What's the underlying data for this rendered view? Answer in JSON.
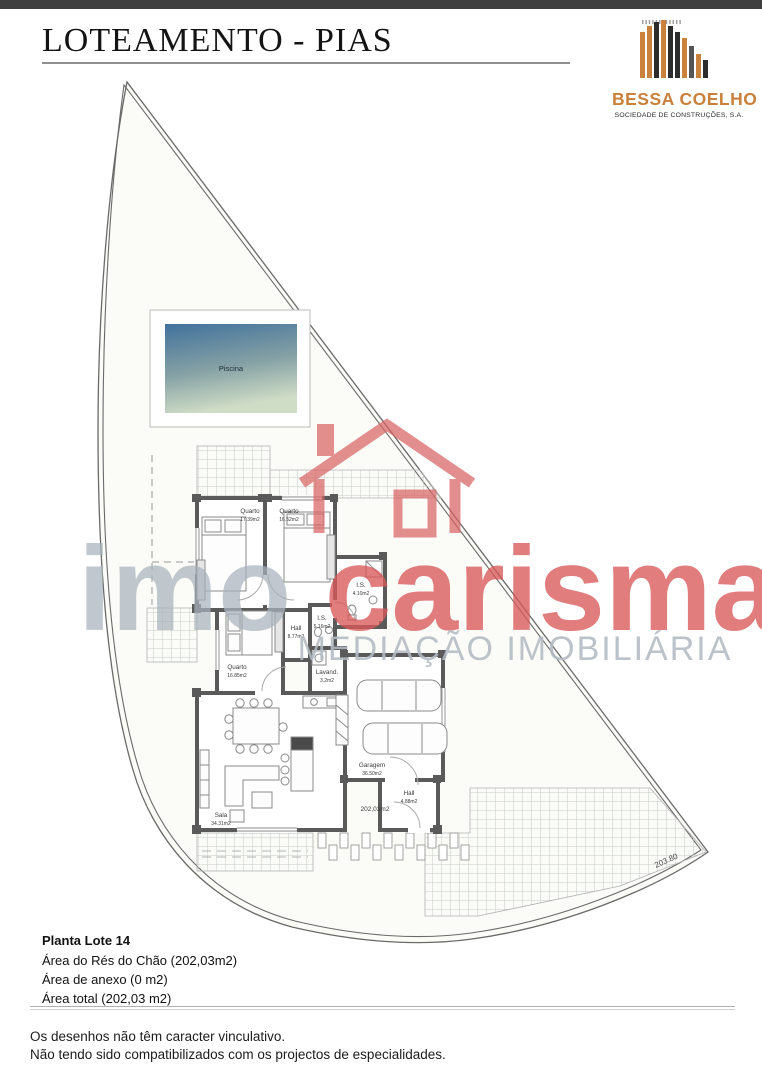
{
  "header": {
    "title": "LOTEAMENTO - PIAS"
  },
  "logo": {
    "name": "BESSA COELHO",
    "subtitle": "SOCIEDADE DE CONSTRUÇÕES, S.A.",
    "accent_color": "#c9813c"
  },
  "watermark": {
    "brand_left": "imo",
    "brand_right": "carisma",
    "tagline": "MEDIAÇÃO IMOBILIÁRIA",
    "red": "#d85858",
    "gray": "#a7b1bb"
  },
  "plan": {
    "pool_label": "Piscina",
    "boundary_dimension": "203.80",
    "total_area": "202,03m2",
    "wall_color": "#5a5a5a",
    "pool_color_top": "#41719c",
    "pool_color_bottom": "#cfdcc6",
    "rooms": [
      {
        "label": "Quarto",
        "area": "17.39m2"
      },
      {
        "label": "Quarto",
        "area": "16.52m2"
      },
      {
        "label": "I.S.",
        "area": "4.10m2"
      },
      {
        "label": "Hall",
        "area": "8.77m2"
      },
      {
        "label": "I.S.",
        "area": "5.16m2"
      },
      {
        "label": "Quarto",
        "area": "16.85m2"
      },
      {
        "label": "Lavand.",
        "area": "3.2m2"
      },
      {
        "label": "Garagem",
        "area": "36.50m2"
      },
      {
        "label": "Hall",
        "area": "4.88m2"
      },
      {
        "label": "Sala",
        "area": "34.31m2"
      }
    ]
  },
  "footer": {
    "lot_title": "Planta Lote 14",
    "area_lines": [
      "Área do Rés do Chão (202,03m2)",
      "Área de anexo (0 m2)",
      "Área total (202,03 m2)"
    ]
  },
  "disclaimer": {
    "line1": "Os desenhos não têm caracter vinculativo.",
    "line2": "Não tendo sido compatibilizados com os projectos de especialidades."
  }
}
